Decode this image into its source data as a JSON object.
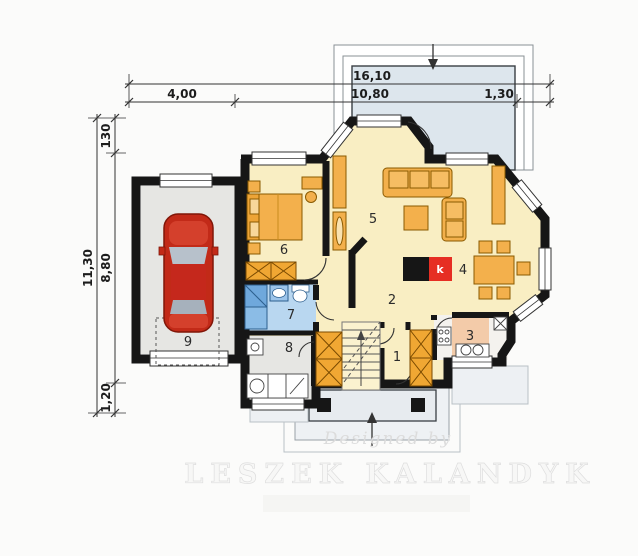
{
  "plan": {
    "dimensions": {
      "top_total": "16,10",
      "top_seg_garage": "4,00",
      "top_seg_house": "10,80",
      "top_seg_bay": "1,30",
      "left_total": "11,30",
      "left_seg_bay": "130",
      "left_seg_house": "8,80",
      "left_seg_porch": "1,20"
    },
    "rooms": [
      {
        "label": "1"
      },
      {
        "label": "2"
      },
      {
        "label": "3"
      },
      {
        "label": "4"
      },
      {
        "label": "5"
      },
      {
        "label": "6"
      },
      {
        "label": "7"
      },
      {
        "label": "8"
      },
      {
        "label": "9"
      }
    ],
    "fireplace": {
      "label": "k"
    },
    "colors": {
      "wall": "#161616",
      "floor_yellow": "#f9eec3",
      "floor_gray": "#e6e6e3",
      "floor_blue": "#b9d7f0",
      "floor_pink": "#f3cba9",
      "terrace_blue": "#dde6ed",
      "furniture_orange": "#f3b04c",
      "car_red": "#c22a18",
      "fireplace_red": "#e62e23"
    }
  },
  "watermark": {
    "byline": "Designed by",
    "name": "LESZEK KALANDYK"
  }
}
